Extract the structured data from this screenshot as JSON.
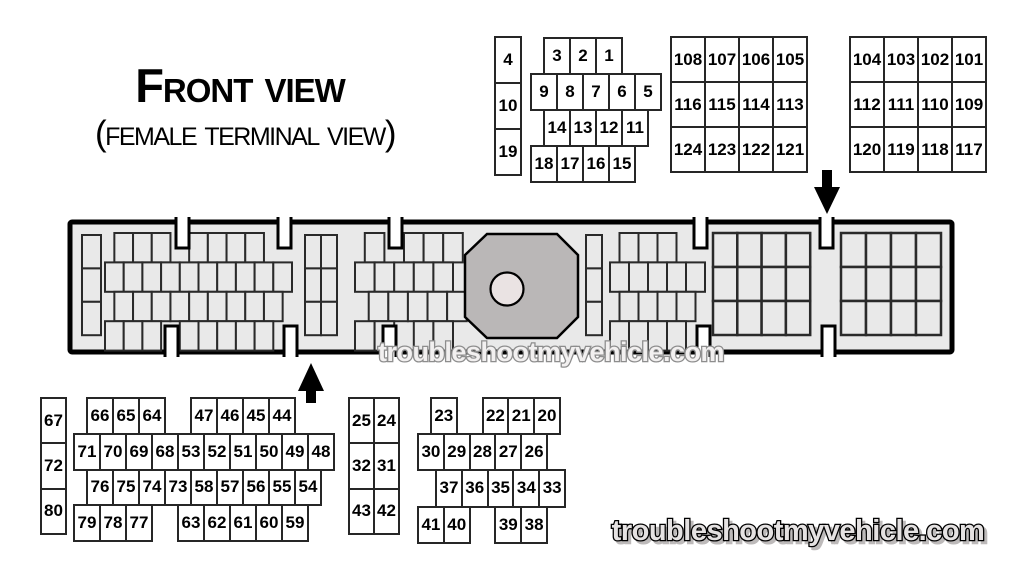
{
  "title": {
    "main": "Front View",
    "sub": "(Female Terminal View)"
  },
  "watermarks": {
    "middle": "troubleshootmyvehicle.com",
    "bottom": "troubleshootmyvehicle.com"
  },
  "pin_grids": {
    "top_column": {
      "cells": [
        "4",
        "10",
        "19"
      ]
    },
    "top_cluster": {
      "rows": [
        {
          "offset": 0.5,
          "cells": [
            "3",
            "2",
            "1"
          ]
        },
        {
          "offset": 0,
          "cells": [
            "9",
            "8",
            "7",
            "6",
            "5"
          ]
        },
        {
          "offset": 0.5,
          "cells": [
            "14",
            "13",
            "12",
            "11"
          ]
        },
        {
          "offset": 0,
          "cells": [
            "18",
            "17",
            "16",
            "15"
          ]
        }
      ]
    },
    "grid_a": {
      "rows": [
        [
          "108",
          "107",
          "106",
          "105"
        ],
        [
          "116",
          "115",
          "114",
          "113"
        ],
        [
          "124",
          "123",
          "122",
          "121"
        ]
      ]
    },
    "grid_b": {
      "rows": [
        [
          "104",
          "103",
          "102",
          "101"
        ],
        [
          "112",
          "111",
          "110",
          "109"
        ],
        [
          "120",
          "119",
          "118",
          "117"
        ]
      ]
    },
    "bl_column": {
      "cells": [
        "67",
        "72",
        "80"
      ]
    },
    "bl_cluster": {
      "rows": [
        {
          "offset": 0.5,
          "cells": [
            "66",
            "65",
            "64",
            null,
            "47",
            "46",
            "45",
            "44"
          ]
        },
        {
          "offset": 0,
          "cells": [
            "71",
            "70",
            "69",
            "68",
            "53",
            "52",
            "51",
            "50",
            "49",
            "48"
          ]
        },
        {
          "offset": 0.5,
          "cells": [
            "76",
            "75",
            "74",
            "73",
            "58",
            "57",
            "56",
            "55",
            "54"
          ]
        },
        {
          "offset": 0,
          "cells": [
            "79",
            "78",
            "77",
            null,
            "63",
            "62",
            "61",
            "60",
            "59"
          ]
        }
      ]
    },
    "bm_grid": {
      "rows": [
        [
          "25",
          "24"
        ],
        [
          "32",
          "31"
        ],
        [
          "43",
          "42"
        ]
      ]
    },
    "bm_cluster": {
      "rows": [
        {
          "offset": 0.5,
          "cells": [
            "23",
            null,
            "22",
            "21",
            "20"
          ]
        },
        {
          "offset": 0,
          "cells": [
            "30",
            "29",
            "28",
            "27",
            "26"
          ]
        },
        {
          "offset": 0.7,
          "cells": [
            "37",
            "36",
            "35",
            "34",
            "33"
          ]
        },
        {
          "offset": 0,
          "cells": [
            "41",
            "40",
            null,
            "39",
            "38"
          ]
        }
      ]
    }
  },
  "colors": {
    "background": "#ffffff",
    "connector_fill": "#e9e9e9",
    "connector_border": "#000000",
    "slot_line": "#2a2a2a",
    "octagon_fill": "#bab7b7",
    "bolt_hole_fill": "#eae3e3",
    "label_cell_border": "#262626",
    "watermark_mid_fill": "#f2f0f0",
    "watermark_mid_outline": "#8d8d8d",
    "watermark_bottom_fill": "#e5e2e2",
    "watermark_bottom_outline": "#000000"
  }
}
